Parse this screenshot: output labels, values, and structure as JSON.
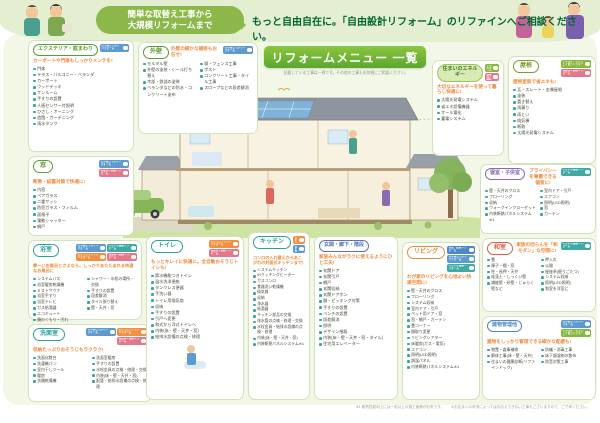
{
  "palette": {
    "accent_green": "#6fb92c",
    "header_green": "#00672f",
    "caption_orange": "#ef8a3c",
    "bullet_teal": "#3aa39b"
  },
  "header": {
    "bubble_line1": "簡単な取替え工事から",
    "bubble_line2": "大規模リフォームまで",
    "title": "もっと自由自在に。「自由設計リフォーム」のリファインへご相談ください。"
  },
  "banner": {
    "label": "リフォームメニュー 一覧",
    "note": "記載している工事は一例です。その他の工事もお気軽にご相談ください。"
  },
  "footnotes": {
    "note1": "※1 断熱性能向上には一定以上の施工面積が目安です。",
    "note2": "※お住まいの状況によってはお応えできない工事もございますので、ご了承ください。"
  },
  "boxes": {
    "exterior": {
      "title": "エクステリア・庭まわり",
      "caption": "カーポートや門扉もしっかりメンテを!",
      "badges": [
        {
          "label": "お手軽しっかりリフォーム",
          "color": "#5d9ad0",
          "icon": "people-icon"
        }
      ],
      "items": [
        "門扉",
        "テラス・バルコニー・ベランダ",
        "カーポート",
        "ウッドデッキ",
        "サンルーム",
        "手すりの設置",
        "人感センサー付照明",
        "ひさし・オーニング",
        "造園・ガーデニング",
        "雨水タンク"
      ]
    },
    "outer_wall": {
      "title": "外壁",
      "caption": "外壁の細かな補修もお任せ!",
      "badges": [
        {
          "label": "お手軽しっかりリフォーム",
          "color": "#5d9ad0",
          "icon": "people-icon"
        }
      ],
      "items_left": [
        "モルタル壁",
        "外壁の塗装・シール打ち替え",
        "木部・鉄部の塗装",
        "ベランダなどの防水・コンクリート塗布"
      ],
      "items_right": [
        "塀・フェンス工事",
        "ポスト",
        "コンクリート工事・タイル工事",
        "スロープなどの段差解消"
      ]
    },
    "window": {
      "title": "窓",
      "caption": "断熱・結露対策で快適に!",
      "badges": [
        {
          "label": "お手軽しっかりリフォーム",
          "color": "#5d9ad0",
          "icon": "people-icon"
        },
        {
          "label": "無理なく節約リフォーム",
          "color": "#e5778c",
          "icon": "kettle-icon"
        }
      ],
      "items": [
        "内窓",
        "ペアガラス",
        "二重サッシ",
        "防犯ガラス・フィルム",
        "面格子",
        "電動シャッター",
        "網戸"
      ]
    },
    "bathroom": {
      "title": "浴室",
      "caption": "寒〜いお風呂とさよなら。しっかりあたたまれる快適なお風呂に",
      "badges": [
        {
          "label": "お手軽しっかりリフォーム",
          "color": "#5d9ad0",
          "icon": "people-icon"
        },
        {
          "label": "いきいき健康リフォーム",
          "color": "#3fa9a5",
          "icon": "hearts-icon"
        },
        {
          "label": "おそうじラクラクリフォーム",
          "color": "#f09140",
          "icon": "soap-icon"
        },
        {
          "label": "無理なく節約リフォーム",
          "color": "#e5778c",
          "icon": "kettle-icon"
        }
      ],
      "items_left": [
        "システムバス",
        "浴室暖房乾燥機",
        "ミストサウナ",
        "浴室手すり",
        "浴室テレビ",
        "ガス給湯器",
        "エコキュート",
        "鏡のくもり・汚れ"
      ],
      "items_right": [
        "シャワー・水栓の場所・交換",
        "手すりの設置",
        "段差解消",
        "タイル張り替え",
        "壁・天井・窓"
      ]
    },
    "washroom": {
      "title": "洗面室",
      "caption": "収納たっぷりおそうじもラクラク!",
      "badges": [
        {
          "label": "お手軽しっかりリフォーム",
          "color": "#5d9ad0",
          "icon": "people-icon"
        },
        {
          "label": "おそうじラクラクリフォーム",
          "color": "#f09140",
          "icon": "soap-icon"
        },
        {
          "label": "無理なく節約リフォーム",
          "color": "#e5778c",
          "icon": "kettle-icon"
        }
      ],
      "items_left": [
        "洗面化粧台",
        "洗濯機パン",
        "室内干しツール",
        "暖房",
        "衣類乾燥機"
      ],
      "items_right": [
        "洗面室暖房",
        "手すりの設置",
        "水栓金具の点検・修理・交換",
        "内装(床・壁・天井・窓)",
        "配管・給排水設備の点検・修理"
      ]
    },
    "toilet": {
      "title": "トイレ",
      "caption": "もっとキレイに快適に。全自動おそうじトイレも!",
      "badges": [
        {
          "label": "おそうじラクラクリフォーム",
          "color": "#f09140",
          "icon": "soap-icon"
        },
        {
          "label": "無理なく節約リフォーム",
          "color": "#e5778c",
          "icon": "kettle-icon"
        }
      ],
      "items": [
        "節水機能つきトイレ",
        "温水洗浄便座",
        "タンクレス便器",
        "手洗い器",
        "トイレ用換気扇",
        "収納",
        "手すりの設置",
        "引戸へ変更",
        "和式から洋式トイレへ",
        "内装(床・壁・天井・窓)",
        "給排水設備の点検・修理"
      ]
    },
    "kitchen": {
      "title": "キッチン",
      "caption": "コンロの入れ替えからあこがれの対面式キッチンまで!",
      "badges": [
        {
          "label": "おそうじラクラクリフォーム",
          "color": "#f09140",
          "icon": "soap-icon"
        },
        {
          "label": "お手軽しっかりリフォーム",
          "color": "#5d9ad0",
          "icon": "people-icon"
        }
      ],
      "items": [
        "システムキッチン",
        "IHクッキングヒーター",
        "ガスコンロ",
        "食器洗い乾燥機",
        "換気扇",
        "収納",
        "浄水器",
        "給湯器",
        "キッチン部品の交換",
        "排水管の点検・修理・交換",
        "水栓金具・給排水設備の点検・修理",
        "内装(床・壁・天井・窓)",
        "内装断熱パネルシステム※1"
      ]
    },
    "entrance": {
      "title": "玄関・廊下・階段",
      "caption": "家族みんながラクに使えるようにひと工夫!",
      "badges": [],
      "items": [
        "玄関ドア",
        "玄関引戸",
        "網戸",
        "玄関収納",
        "玄関ドアホン",
        "鍵・ピッキング対策",
        "手すりの設置",
        "ベンチの設置",
        "段差解消",
        "照明",
        "デザイン階段",
        "内装(床・壁・天井・窓・タイル)",
        "住宅用エレベーター"
      ]
    },
    "living": {
      "title": "リビング",
      "caption": "わが家のリビングを心地よい快適空間に!",
      "badges": [
        {
          "label": "断熱・結露リフォーム",
          "color": "#4f86c6",
          "icon": "snow-icon"
        },
        {
          "label": "お手軽しっかりリフォーム",
          "color": "#5d9ad0",
          "icon": "people-icon"
        },
        {
          "label": "いきいき健康リフォーム",
          "color": "#3fa9a5",
          "icon": "hearts-icon"
        }
      ],
      "items": [
        "壁・天井のクロス",
        "フローリング",
        "システム収納",
        "室内ドア・引戸",
        "ペット用ドア・窓",
        "窓・網戸・カーテン",
        "畳コーナー",
        "間取り変更",
        "リビングシアター",
        "床暖房(ガス・電気)",
        "エアコン",
        "照明(LED照明)",
        "調湿パネル",
        "内装断熱パネルシステム※1"
      ]
    },
    "bedroom": {
      "title": "寝室・子供室",
      "caption": "プライバシーを尊重できる個室に!",
      "badges": [
        {
          "label": "いきいき健康リフォーム",
          "color": "#3fa9a5",
          "icon": "hearts-icon"
        }
      ],
      "items_left": [
        "壁・天井のクロス",
        "フローリング",
        "収納",
        "ウォークインクローゼット",
        "内装断熱パネルシステム※1"
      ],
      "items_right": [
        "室内ドア・引戸",
        "エアコン",
        "照明(LED照明)",
        "窓",
        "カーテン"
      ]
    },
    "japanese_room": {
      "title": "和室",
      "caption": "家族の団らんを「和モダン」な空間に!",
      "badges": [
        {
          "label": "いきいき健康リフォーム",
          "color": "#3fa9a5",
          "icon": "hearts-icon"
        }
      ],
      "items_left": [
        "畳",
        "障子・襖・窓",
        "柱・長押・天井",
        "珪藻土・しっくい壁",
        "繊維壁・砂壁・じゅらく壁など"
      ],
      "items_right": [
        "押入れ",
        "仏間",
        "掘座卓(掘りごたつ)",
        "システム収納",
        "照明(LED照明)",
        "和室を洋室に"
      ]
    },
    "roof": {
      "title": "屋根",
      "caption": "屋根塗装で省エネも!",
      "badges": [
        {
          "label": "エネルギーをかしこく使うリフォーム",
          "color": "#86b83d",
          "icon": "leaf-icon"
        },
        {
          "label": "無理なく節約リフォーム",
          "color": "#e5778c",
          "icon": "kettle-icon"
        }
      ],
      "items": [
        "瓦・スレート・金属屋根",
        "塗装",
        "葺き替え",
        "雨漏り",
        "雨とい",
        "換気棟",
        "断熱",
        "太陽光発電システム"
      ]
    },
    "energy": {
      "title": "住まいのエネルギー",
      "caption": "大切なエネルギーを使って暮らし快適に!",
      "badges": [
        {
          "label": "エネルギーをかしこく使うリフォーム",
          "color": "#86b83d",
          "icon": "leaf-icon"
        },
        {
          "label": "無理なく節約リフォーム",
          "color": "#e5778c",
          "icon": "kettle-icon"
        }
      ],
      "items": [
        "太陽光発電システム",
        "省エネ設備機器",
        "オール電化",
        "蓄電システム"
      ]
    },
    "building": {
      "title": "建物管理他",
      "caption": "建物をしっかり管理できる細かな配慮も!",
      "badges": [
        {
          "label": "お手軽しっかりリフォーム",
          "color": "#5d9ad0",
          "icon": "people-icon"
        },
        {
          "label": "エネルギーをかしこく使うリフォーム",
          "color": "#86b83d",
          "icon": "leaf-icon"
        }
      ],
      "items_left": [
        "物置・倉庫補修",
        "解体工事(床・壁・天井)",
        "住まいの健康診断(リファインドック)"
      ],
      "items_right": [
        "防蟻・消毒工事",
        "床下調湿剤の散布",
        "防音対策工事"
      ]
    }
  }
}
